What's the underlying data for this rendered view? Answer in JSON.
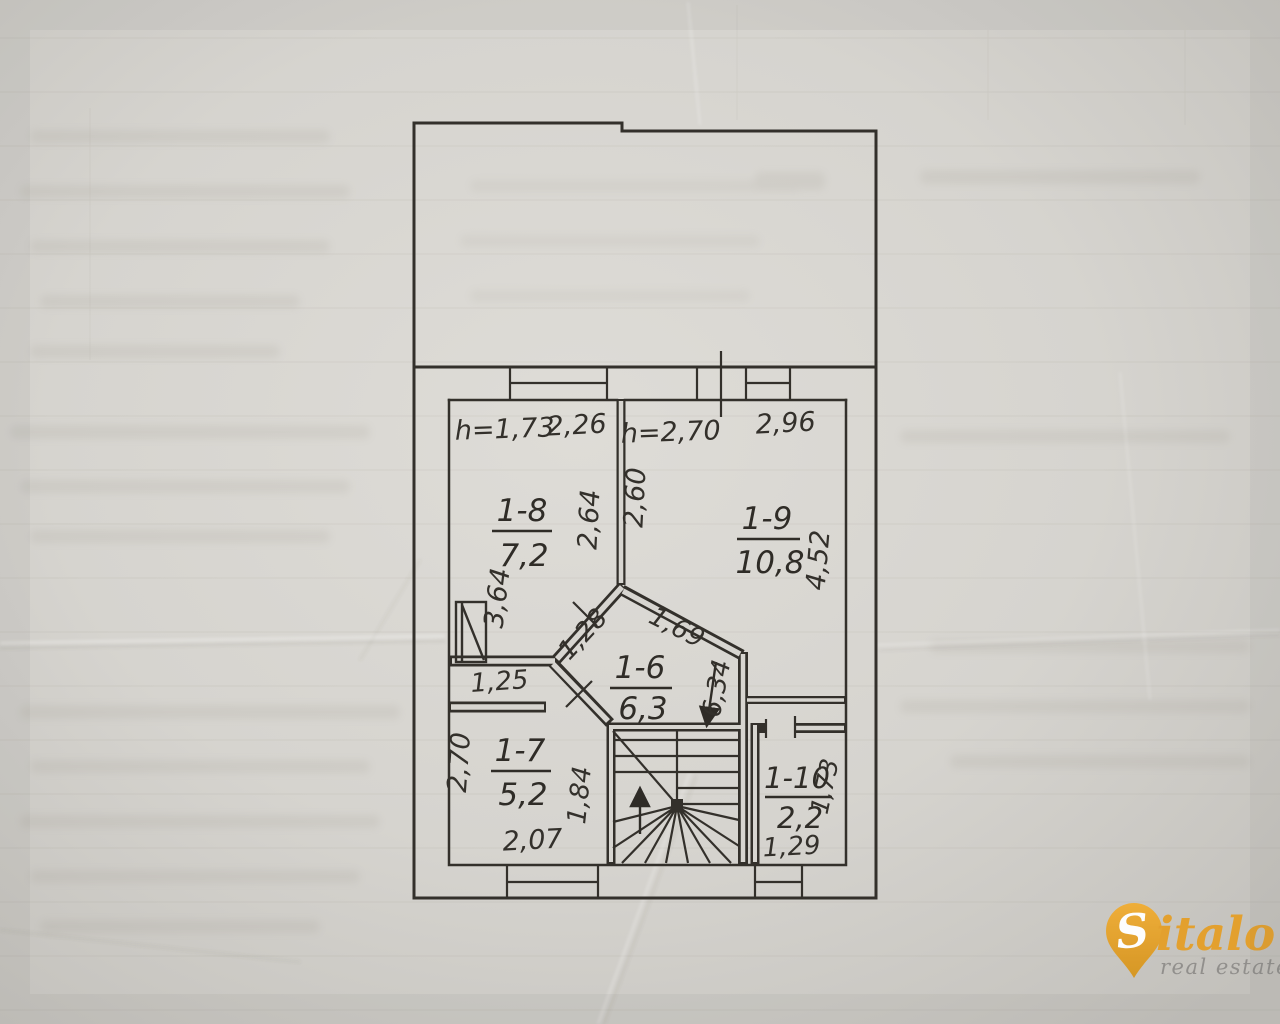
{
  "document": {
    "kind": "BTI floor plan photograph",
    "paper_color": "#d8d6d1",
    "ink_color": "#33302b"
  },
  "plan": {
    "rooms": [
      {
        "id": "1-8",
        "area": "7,2",
        "ceiling_height": "h=1,73"
      },
      {
        "id": "1-9",
        "area": "10,8",
        "ceiling_height": "h=2,70"
      },
      {
        "id": "1-6",
        "area": "6,3"
      },
      {
        "id": "1-7",
        "area": "5,2"
      },
      {
        "id": "1-10",
        "area": "2,2"
      }
    ],
    "dimensions": {
      "room18_width": "2,26",
      "room18_right": "2,64",
      "room18_left": "3,64",
      "room19_width": "2,96",
      "room19_left": "2,60",
      "room19_right": "4,52",
      "hall_nw": "1,28",
      "hall_ne": "1,69",
      "stair_run": "6,34",
      "corridor": "1,25",
      "room17_left": "2,70",
      "room17_right": "1,84",
      "room17_bottom": "2,07",
      "room110_right": "1,73",
      "room110_bottom": "1,29"
    }
  },
  "watermark": {
    "brand_initial": "S",
    "brand_rest": "italo",
    "tagline": "real estate",
    "pin_color": "#eaa42e",
    "text_color": "#e49f28",
    "tagline_color": "#8f8d8a"
  }
}
